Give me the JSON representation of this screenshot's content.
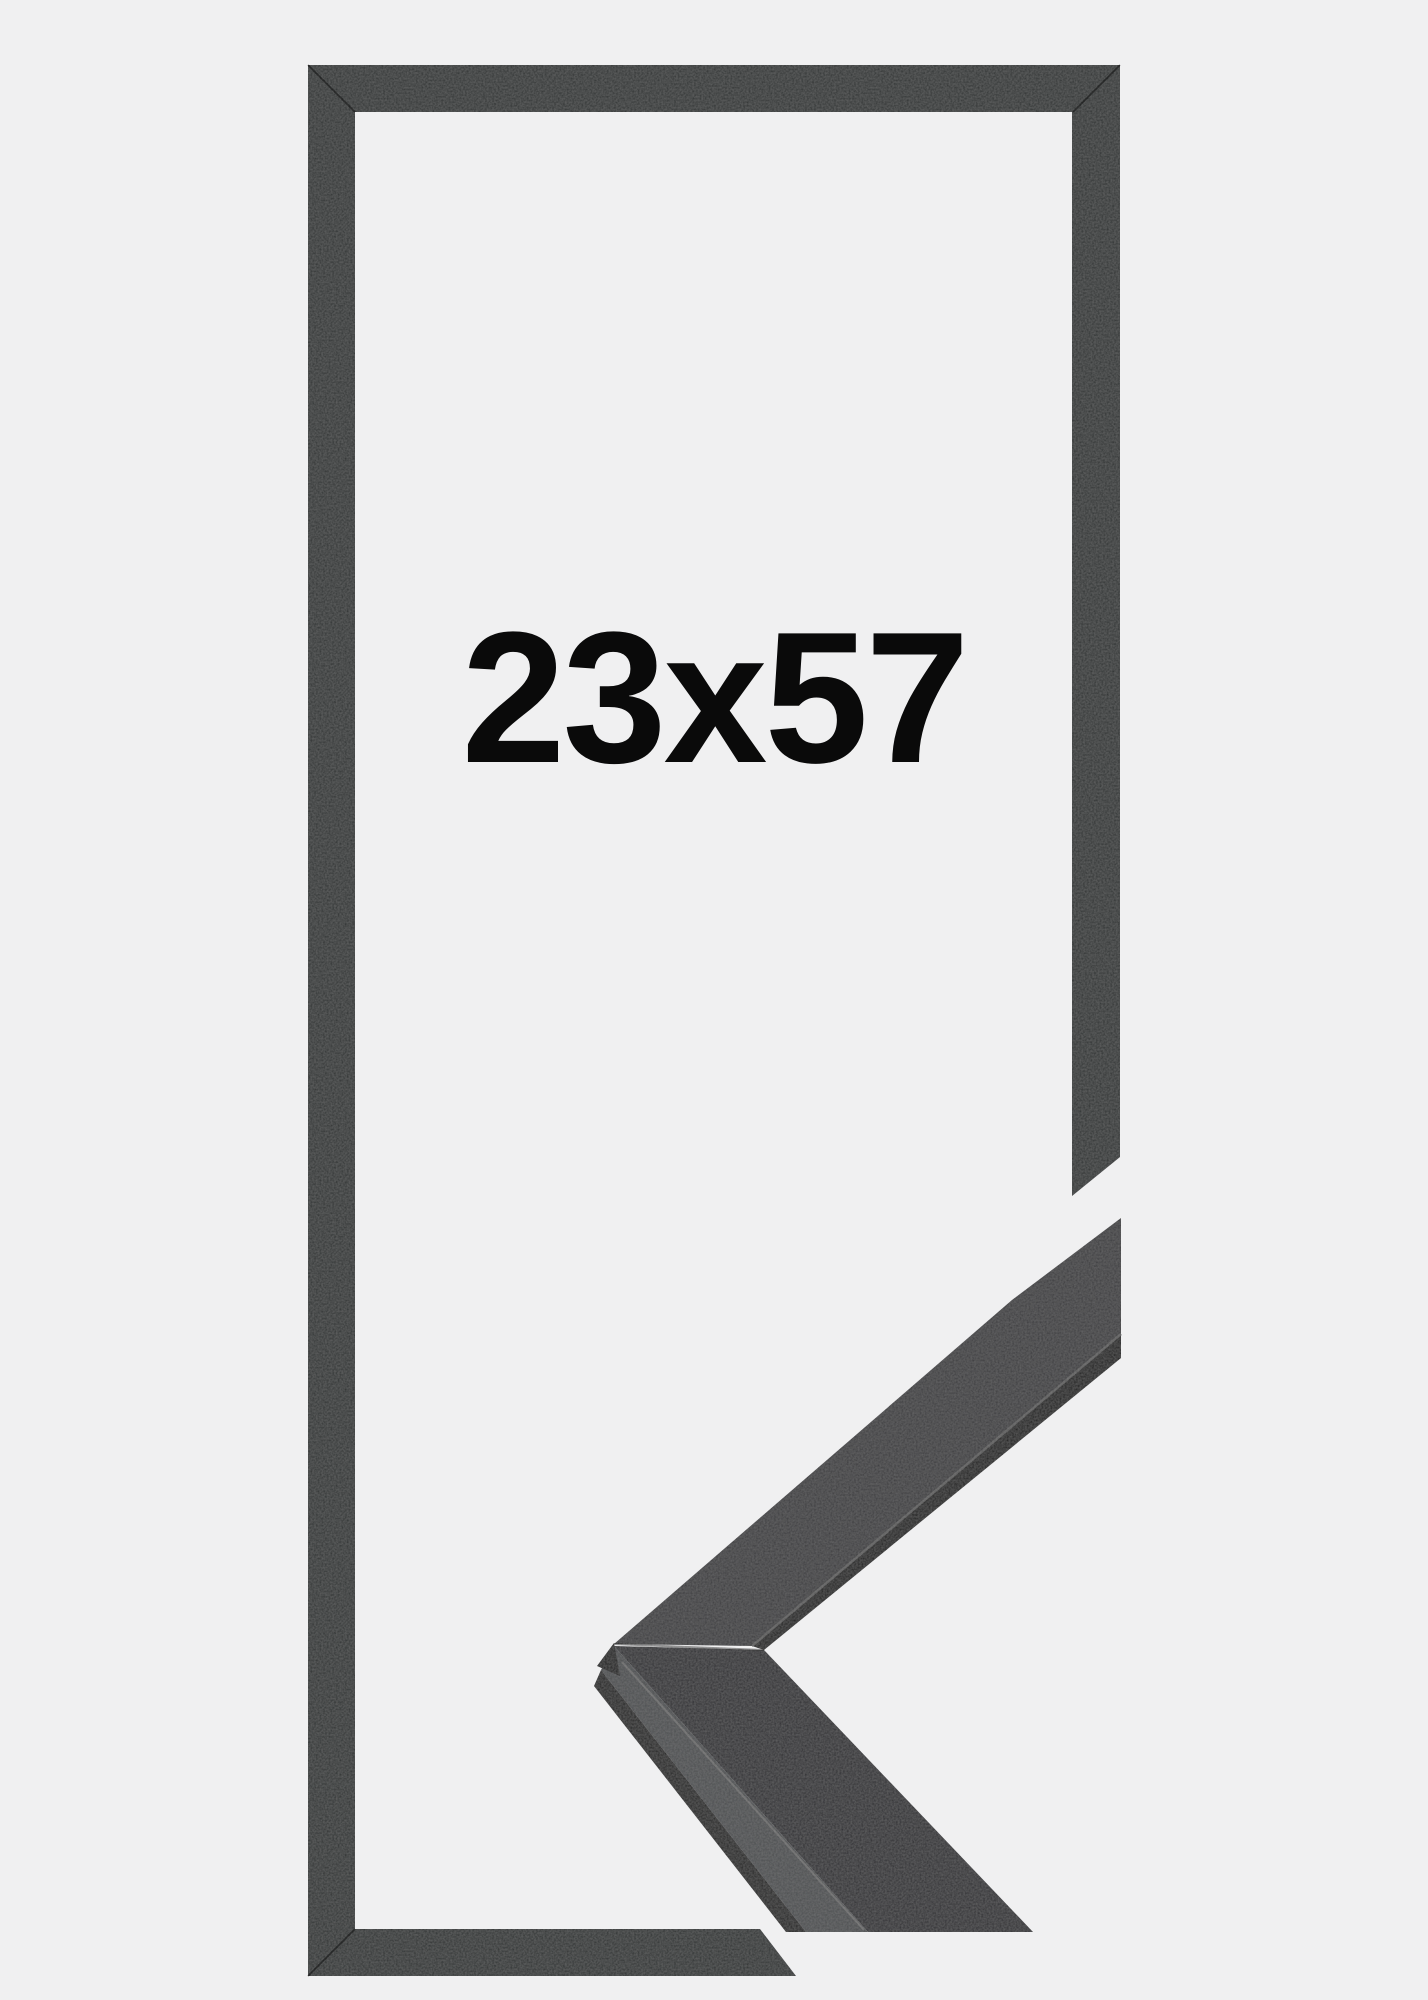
{
  "product_image": {
    "size_label": "23x57",
    "label_color": "#0a0a0a",
    "background_color": "#f0f0f1",
    "frame": {
      "outline_color": "#2e3032"
    },
    "corner_sample": {
      "upper_face_color": "#3a3a3c",
      "inner_lip_color": "#1e1e1e",
      "separator_color": "#5f5f5f",
      "lower_face_color": "#2f2f31",
      "side_color": "#4c4e50",
      "bottom_edge_color": "#242424",
      "highlight_color": "#707070",
      "chamfer_color": "#1b1b1b"
    }
  }
}
